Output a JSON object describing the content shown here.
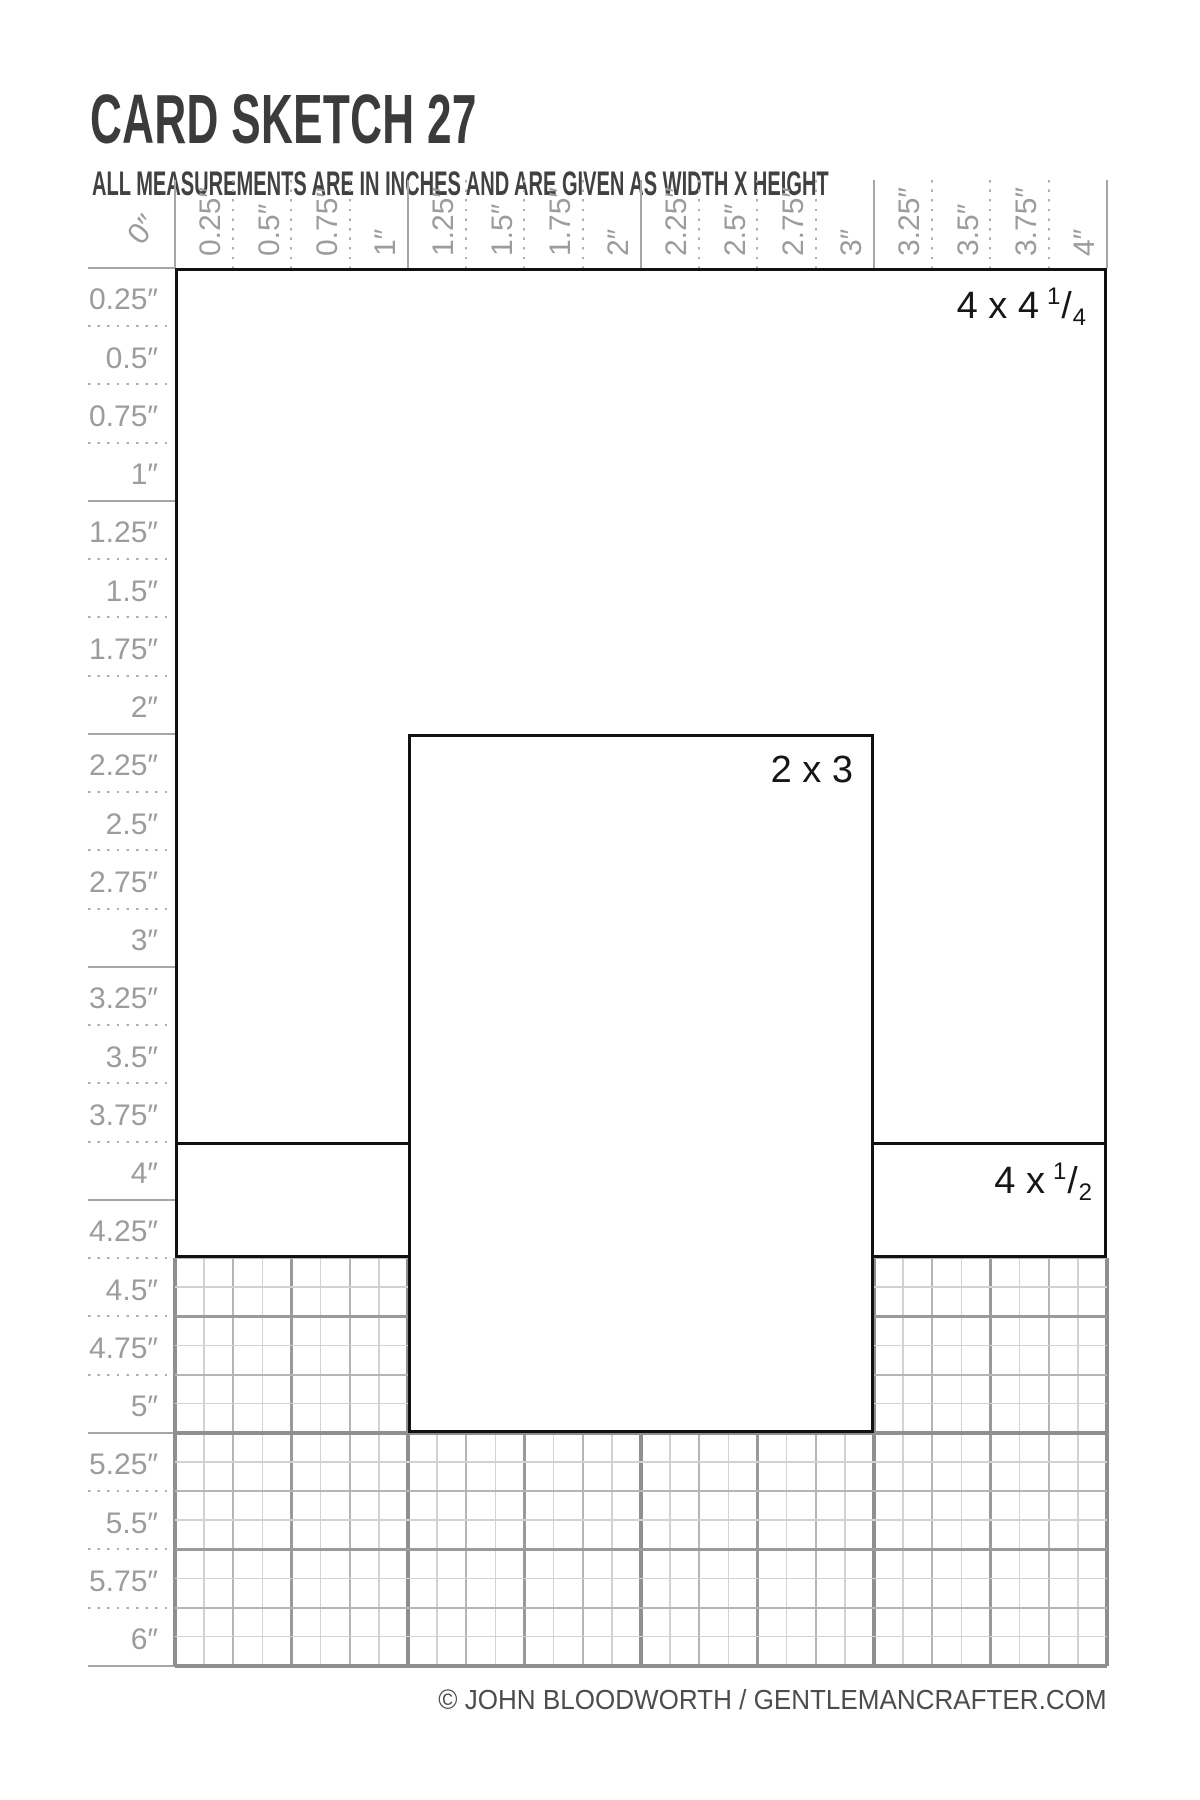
{
  "header": {
    "title": "CARD SKETCH 27",
    "subtitle": "ALL MEASUREMENTS ARE IN INCHES AND ARE GIVEN AS WIDTH X HEIGHT"
  },
  "rulers": {
    "unit": "inches",
    "top_labels": [
      "0″",
      "0.25″",
      "0.5″",
      "0.75″",
      "1″",
      "1.25″",
      "1.5″",
      "1.75″",
      "2″",
      "2.25″",
      "2.5″",
      "2.75″",
      "3″",
      "3.25″",
      "3.5″",
      "3.75″",
      "4″"
    ],
    "left_labels": [
      "0.25″",
      "0.5″",
      "0.75″",
      "1″",
      "1.25″",
      "1.5″",
      "1.75″",
      "2″",
      "2.25″",
      "2.5″",
      "2.75″",
      "3″",
      "3.25″",
      "3.5″",
      "3.75″",
      "4″",
      "4.25″",
      "4.5″",
      "4.75″",
      "5″",
      "5.25″",
      "5.5″",
      "5.75″",
      "6″"
    ]
  },
  "panels": [
    {
      "id": "panel-4x4-quarter",
      "label_prefix": "4 x 4",
      "frac": {
        "num": "1",
        "den": "4"
      },
      "x_in": 0,
      "y_in": 0,
      "width_in": 4,
      "height_in": 4.25
    },
    {
      "id": "panel-2x3",
      "label_prefix": "2 x 3",
      "frac": null,
      "x_in": 1,
      "y_in": 2,
      "width_in": 2,
      "height_in": 3
    },
    {
      "id": "panel-4x-half",
      "label_prefix": "4 x",
      "frac": {
        "num": "1",
        "den": "2"
      },
      "x_in": 0,
      "y_in": 3.75,
      "width_in": 4,
      "height_in": 0.5
    }
  ],
  "footer": {
    "credit": "© JOHN BLOODWORTH / GENTLEMANCRAFTER.COM"
  },
  "colors": {
    "ink": "#3b3b3b",
    "ruler_gray": "#9c9c9c",
    "panel_border": "#111111",
    "grid_minor": "#d2d2d2",
    "grid_quarter": "#b5b5b5",
    "grid_half": "#9a9a9a",
    "grid_inch": "#8f8f8f"
  }
}
